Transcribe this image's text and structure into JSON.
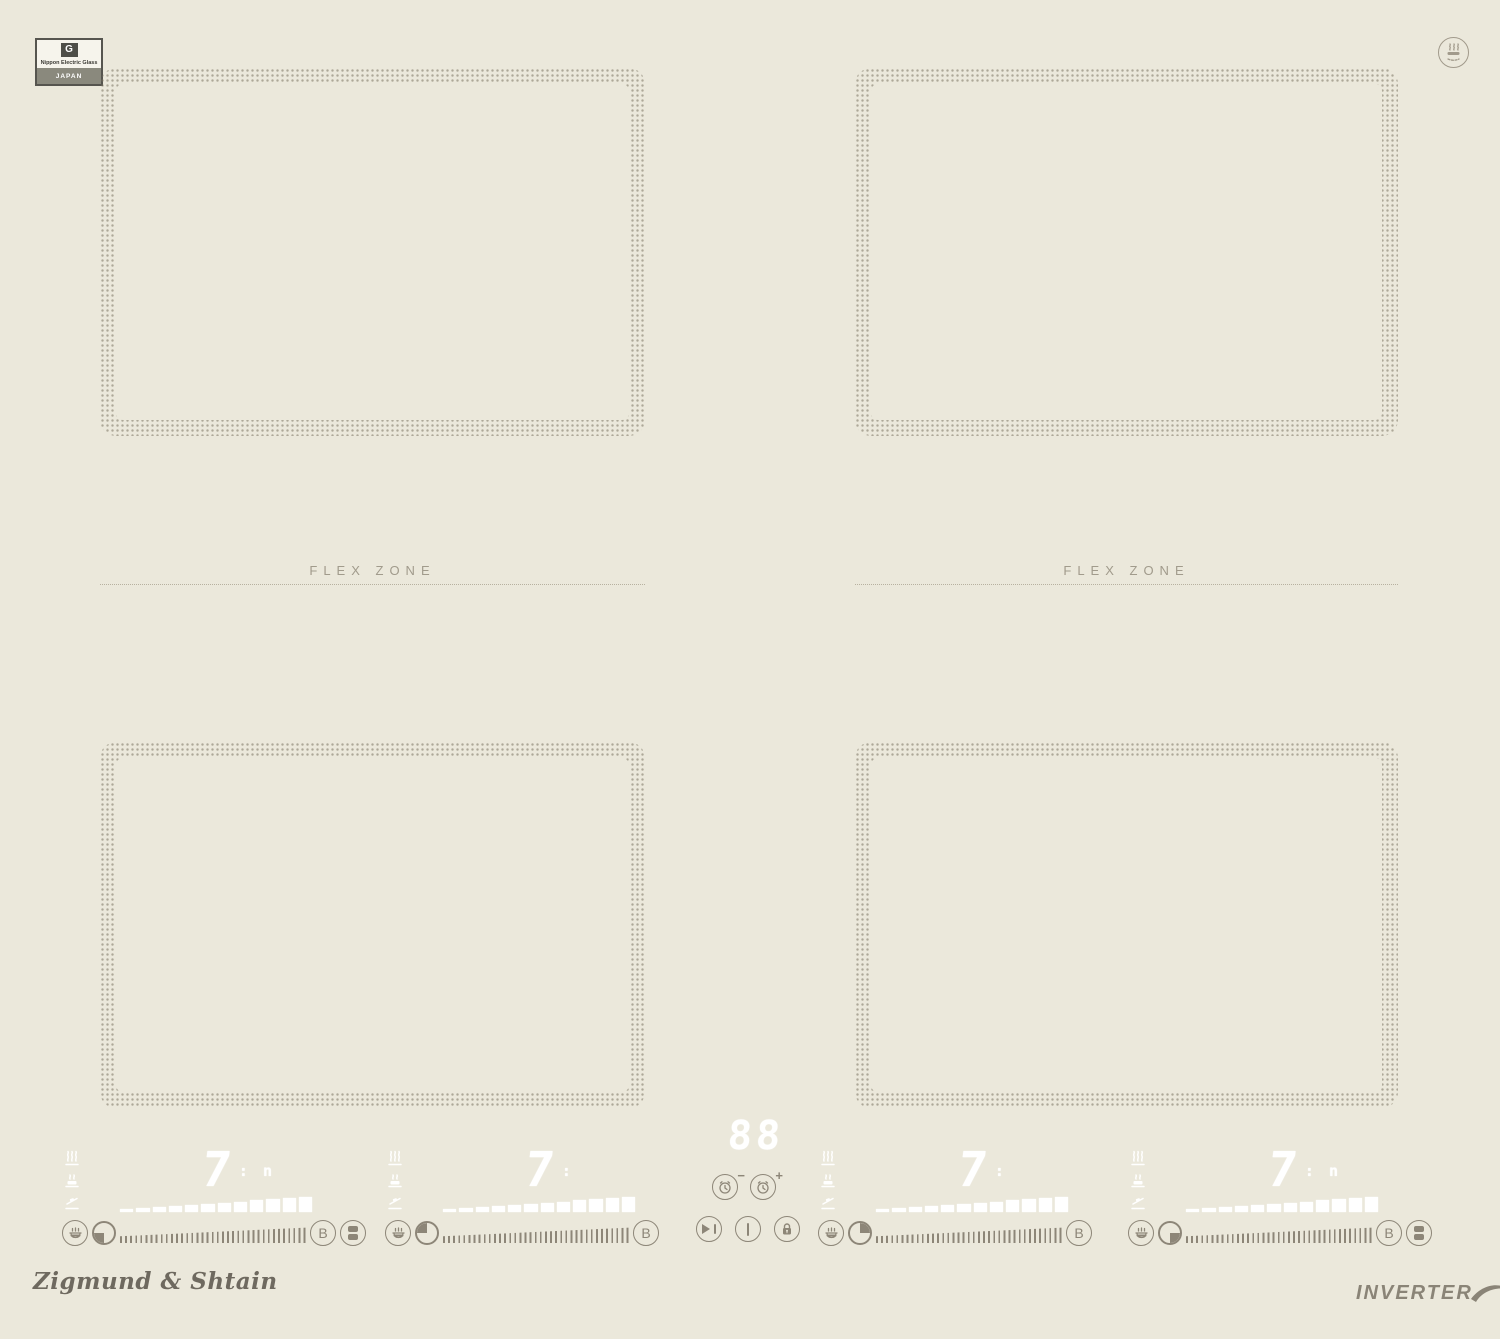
{
  "colors": {
    "background": "#ebe8db",
    "printed_controls": "#8d8678",
    "display_elements": "#ffffff",
    "zone_dots": "#7a7260",
    "label_gray": "#a19b8c"
  },
  "badge": {
    "logo_letter": "G",
    "maker": "Nippon Electric Glass",
    "country": "JAPAN"
  },
  "flex_zone": {
    "label": "FLEX ZONE"
  },
  "timer": {
    "display": "88",
    "minus_sign": "−",
    "plus_sign": "+"
  },
  "burners": [
    {
      "name": "front-left",
      "power": "7",
      "suffix": ": n",
      "boost_label": "B",
      "position_quadrant": "bottom-left",
      "has_bridge": true,
      "power_bar_segments": 12
    },
    {
      "name": "rear-left",
      "power": "7",
      "suffix": ":",
      "boost_label": "B",
      "position_quadrant": "top-left",
      "has_bridge": false,
      "power_bar_segments": 12
    },
    {
      "name": "rear-right",
      "power": "7",
      "suffix": ":",
      "boost_label": "B",
      "position_quadrant": "top-right",
      "has_bridge": false,
      "power_bar_segments": 12
    },
    {
      "name": "front-right",
      "power": "7",
      "suffix": ": n",
      "boost_label": "B",
      "position_quadrant": "bottom-right",
      "has_bridge": true,
      "power_bar_segments": 12
    }
  ],
  "branding": {
    "logo_text": "Zigmund & Shtain",
    "inverter_label": "INVERTER"
  },
  "icons": {
    "top_right": "induction-pan-symbol",
    "per_burner_stack": [
      "boil-icon",
      "simmer-icon",
      "melt-icon"
    ],
    "per_burner_row": [
      "keep-warm-pot-icon",
      "zone-position-pie",
      "power-slider",
      "boost-button",
      "bridge-button"
    ],
    "center": [
      "timer-minus-button",
      "timer-plus-button",
      "pause-play-button",
      "power-button",
      "child-lock-button"
    ]
  }
}
